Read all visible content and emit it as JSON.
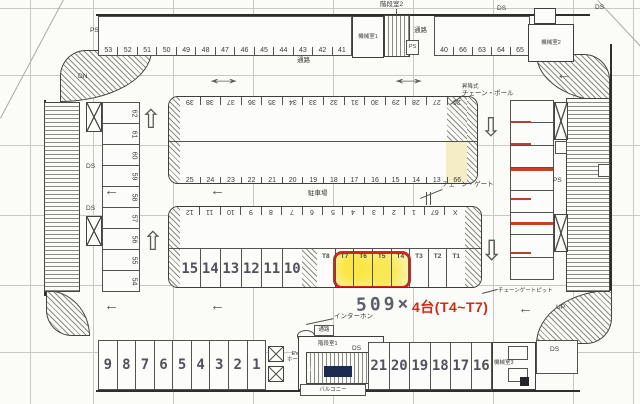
{
  "caption": {
    "prefix": "509×",
    "red": "4台(T4~T7)"
  },
  "rooms": {
    "machine1": "機械室1",
    "machine2": "機械室2",
    "machine3": "機械室3",
    "stairwell1": "階段室1",
    "stairwell2": "階段室2",
    "ev_hall_line1": "EV",
    "ev_hall_line2": "ホール",
    "balcony": "バルコニー"
  },
  "labels": {
    "ds": "DS",
    "ps": "PS",
    "dn": "DN",
    "up": "UP",
    "u": "U",
    "passage": "通路",
    "parking_area": "駐車場",
    "intercom": "インターホン",
    "chain_gate": "チェーン・ゲート",
    "chain_pole_type": "昇降式",
    "chain_pole": "チェーン・ポール",
    "chain_gate_pit": "チェーンゲートピット"
  },
  "stalls": {
    "top_left": [
      "53",
      "52",
      "51",
      "50",
      "49",
      "48",
      "47",
      "46",
      "45",
      "44",
      "43",
      "42",
      "41"
    ],
    "top_right": [
      "40",
      "66",
      "63",
      "64",
      "65"
    ],
    "left_col": [
      "62",
      "61",
      "60",
      "59",
      "58",
      "57",
      "56",
      "55",
      "54"
    ],
    "upper_island_top": [
      "39",
      "38",
      "37",
      "36",
      "35",
      "34",
      "33",
      "32",
      "31",
      "30",
      "29",
      "28",
      "27",
      "26"
    ],
    "upper_island_bottom": [
      "25",
      "24",
      "23",
      "22",
      "21",
      "20",
      "19",
      "18",
      "17",
      "16",
      "15",
      "14",
      "13",
      "66"
    ],
    "lower_island_top": [
      "12",
      "11",
      "10",
      "9",
      "8",
      "7",
      "6",
      "5",
      "4",
      "3",
      "2",
      "1",
      "67",
      "X"
    ],
    "lower_island_big": [
      "15",
      "14",
      "13",
      "12",
      "11",
      "10"
    ],
    "t_stalls": [
      "T8",
      "T7",
      "T6",
      "T5",
      "T4",
      "T3",
      "T2",
      "T1"
    ],
    "t_highlighted": [
      "T7",
      "T6",
      "T5",
      "T4"
    ],
    "bottom_row1": [
      "9",
      "8",
      "7",
      "6",
      "5",
      "4",
      "3",
      "2",
      "1"
    ],
    "bottom_row2": [
      "21",
      "20",
      "19",
      "18",
      "17",
      "16"
    ]
  },
  "colors": {
    "highlight_border": "#d2261a",
    "highlight_fill": "#f6ee8e",
    "stall_mark_red": "#b5412f",
    "caption_red": "#d0281c"
  }
}
